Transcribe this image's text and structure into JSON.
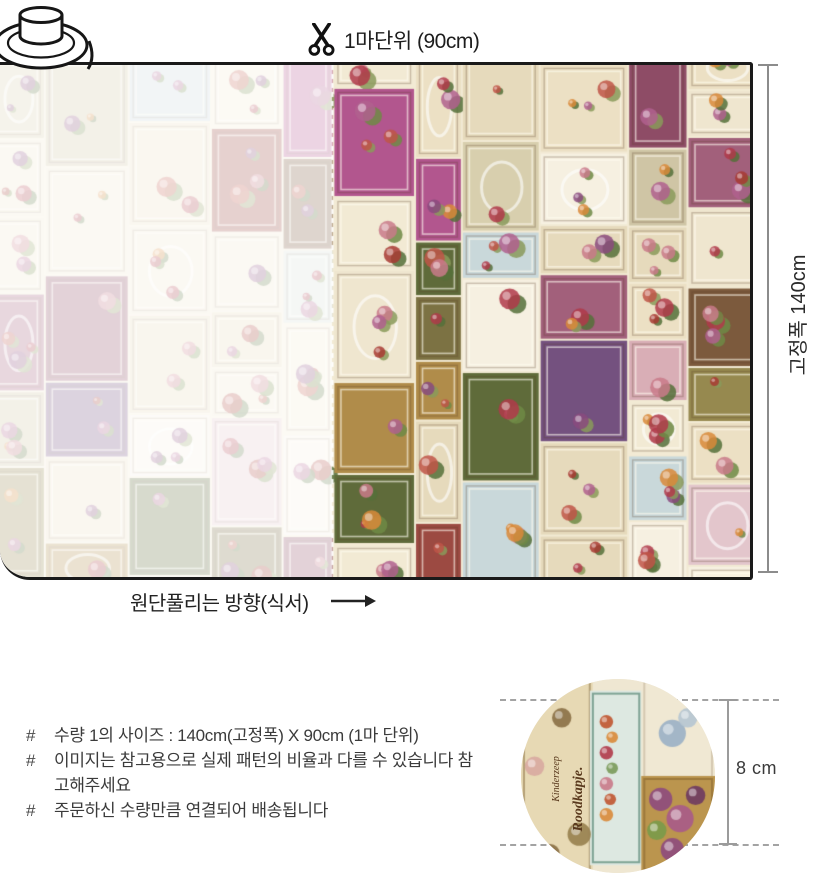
{
  "diagram": {
    "roll_icon": "fabric-roll",
    "cut": {
      "icon": "scissors",
      "label": "1마단위 (90cm)"
    },
    "width_measure": {
      "label": "고정폭 140cm"
    },
    "grain": {
      "label": "원단풀리는 방향(식서)",
      "arrow_icon": "arrow-right"
    }
  },
  "notes": {
    "bullet": "#",
    "items": [
      "수량 1의 사이즈 : 140cm(고정폭) X 90cm (1마 단위)",
      "이미지는 참고용으로 실제 패턴의 비율과 다를 수 있습니다 참고해주세요",
      "주문하신 수량만큼 연결되어 배송됩니다"
    ]
  },
  "detail": {
    "scale_label": "8 cm",
    "print_texts": {
      "small": "Kinderzeep",
      "large": "Roodkapje."
    },
    "print": {
      "base": "#efe7d2",
      "panels": [
        {
          "x": 0,
          "y": 0,
          "w": 0.37,
          "h": 1,
          "color": "#e7d9b4",
          "frame": "rgba(120,90,45,0.45)"
        },
        {
          "x": 0.355,
          "y": 0.06,
          "w": 0.27,
          "h": 0.9,
          "color": "#dde8e1",
          "frame": "rgba(110,150,135,0.85)"
        },
        {
          "x": 0.62,
          "y": 0,
          "w": 0.38,
          "h": 0.52,
          "color": "#f0e8d3",
          "frame": "rgba(150,130,100,0.3)"
        },
        {
          "x": 0.62,
          "y": 0.5,
          "w": 0.38,
          "h": 0.5,
          "color": "#bb954e",
          "frame": "rgba(100,70,30,0.35)"
        }
      ],
      "blobs": [
        {
          "x": 0.1,
          "y": 0.1,
          "r": 0.06,
          "c": "#c87f6f"
        },
        {
          "x": 0.21,
          "y": 0.2,
          "r": 0.05,
          "c": "#8a6f45"
        },
        {
          "x": 0.07,
          "y": 0.45,
          "r": 0.05,
          "c": "#d8a8a0"
        },
        {
          "x": 0.3,
          "y": 0.8,
          "r": 0.06,
          "c": "#97804e"
        },
        {
          "x": 0.15,
          "y": 0.9,
          "r": 0.05,
          "c": "#8a6f45"
        },
        {
          "x": 0.44,
          "y": 0.22,
          "r": 0.035,
          "c": "#c05530"
        },
        {
          "x": 0.47,
          "y": 0.3,
          "r": 0.03,
          "c": "#d98a3a"
        },
        {
          "x": 0.44,
          "y": 0.38,
          "r": 0.035,
          "c": "#b03a4a"
        },
        {
          "x": 0.47,
          "y": 0.46,
          "r": 0.03,
          "c": "#7a9a5a"
        },
        {
          "x": 0.44,
          "y": 0.54,
          "r": 0.035,
          "c": "#c97a8a"
        },
        {
          "x": 0.46,
          "y": 0.62,
          "r": 0.03,
          "c": "#c05530"
        },
        {
          "x": 0.44,
          "y": 0.7,
          "r": 0.035,
          "c": "#d98a3a"
        },
        {
          "x": 0.78,
          "y": 0.28,
          "r": 0.07,
          "c": "#9ab0c5"
        },
        {
          "x": 0.86,
          "y": 0.2,
          "r": 0.05,
          "c": "#b5c5d2"
        },
        {
          "x": 0.72,
          "y": 0.62,
          "r": 0.06,
          "c": "#8e4a7e"
        },
        {
          "x": 0.82,
          "y": 0.72,
          "r": 0.07,
          "c": "#a85a8a"
        },
        {
          "x": 0.9,
          "y": 0.6,
          "r": 0.05,
          "c": "#6e3a62"
        },
        {
          "x": 0.7,
          "y": 0.78,
          "r": 0.05,
          "c": "#7a9a4a"
        },
        {
          "x": 0.78,
          "y": 0.88,
          "r": 0.06,
          "c": "#8e4a7e"
        }
      ]
    }
  },
  "fabric_print": {
    "name": "vintage-label-collage",
    "seed": 77,
    "faded_opacity": 0.75,
    "cut_line_x": 332,
    "palette": {
      "cream": [
        "#f2ead4",
        "#ece0c4",
        "#f6f0e1",
        "#e6dabc",
        "#efe6cf"
      ],
      "soft": [
        "#e3c6cc",
        "#d9aeb6",
        "#d6dfd8",
        "#c9d8da",
        "#d8cfae",
        "#cfc5a5"
      ],
      "strong": [
        "#a2607b",
        "#8e4c66",
        "#b2568e",
        "#7c7243",
        "#96894f",
        "#7c5a3d",
        "#9c4a42",
        "#74517f",
        "#b08c4a",
        "#5f6b3a"
      ],
      "flower": [
        "#a83a32",
        "#c05548",
        "#c97a8a",
        "#8a4a7e",
        "#b0608e",
        "#d98a3a",
        "#b03a4a"
      ],
      "leaf": [
        "#6f8a45",
        "#55703a",
        "#8a9a5a"
      ]
    }
  }
}
